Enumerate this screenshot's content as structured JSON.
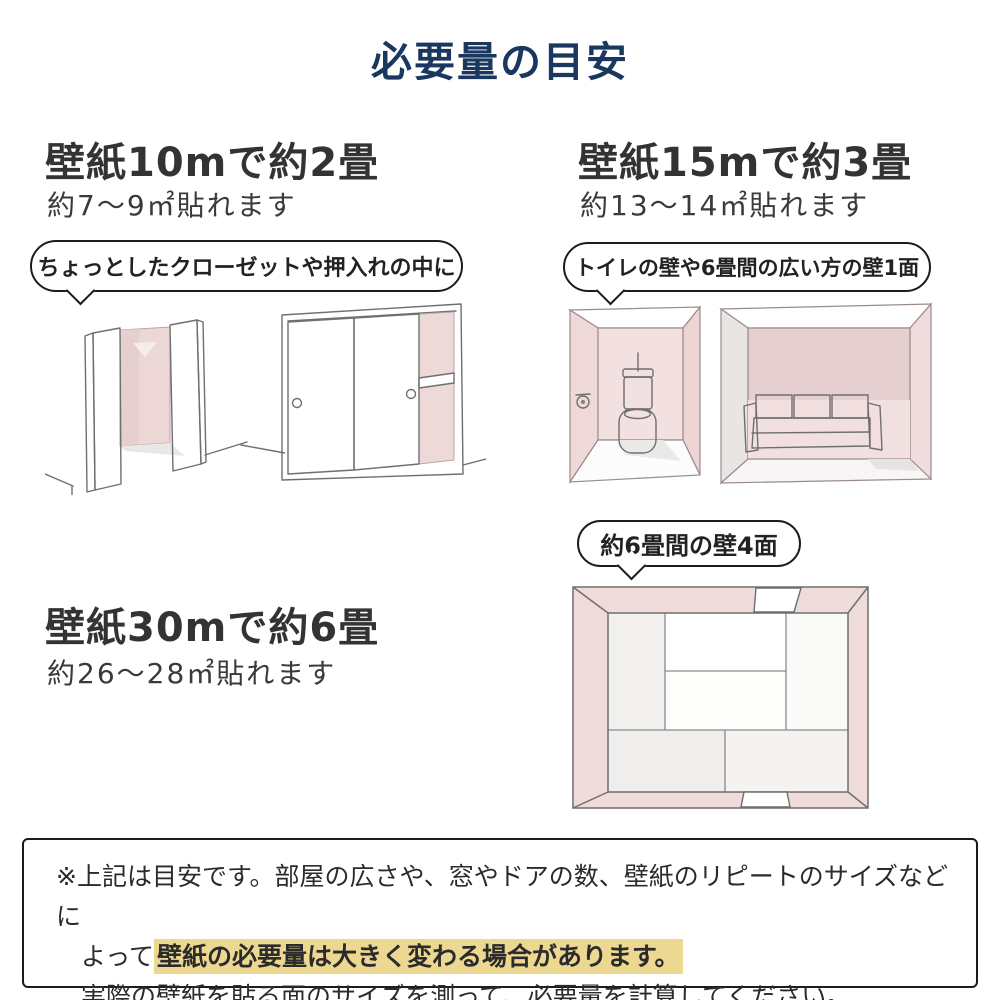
{
  "title": "必要量の目安",
  "sections": {
    "s10m": {
      "heading": "壁紙10mで約2畳",
      "subheading": "約7〜9㎡貼れます",
      "bubble": "ちょっとしたクローゼットや押入れの中に"
    },
    "s15m": {
      "heading": "壁紙15mで約3畳",
      "subheading": "約13〜14㎡貼れます",
      "bubble": "トイレの壁や6畳間の広い方の壁1面"
    },
    "s30m": {
      "heading": "壁紙30mで約6畳",
      "subheading": "約26〜28㎡貼れます",
      "bubble": "約6畳間の壁4面"
    }
  },
  "note": {
    "line1": "※上記は目安です。部屋の広さや、窓やドアの数、壁紙のリピートのサイズなどに",
    "line2_prefix": "よって",
    "line2_highlight": "壁紙の必要量は大きく変わる場合があります。",
    "line3": "実際の壁紙を貼る面のサイズを測って、必要量を計算してください。"
  },
  "illustrations": {
    "closet_open": "open-closet-sketch",
    "closet_sliding": "sliding-door-closet-sketch",
    "toilet_room": "toilet-room-sketch",
    "living_room": "living-room-sofa-sketch",
    "tatami_room": "six-tatami-room-top-view-sketch"
  },
  "colors": {
    "title_navy": "#1a3760",
    "body_text": "#333333",
    "highlight_yellow": "#edd892",
    "wall_pink": "#f1dcdc",
    "wall_pink_dark": "#e5cfd0"
  }
}
